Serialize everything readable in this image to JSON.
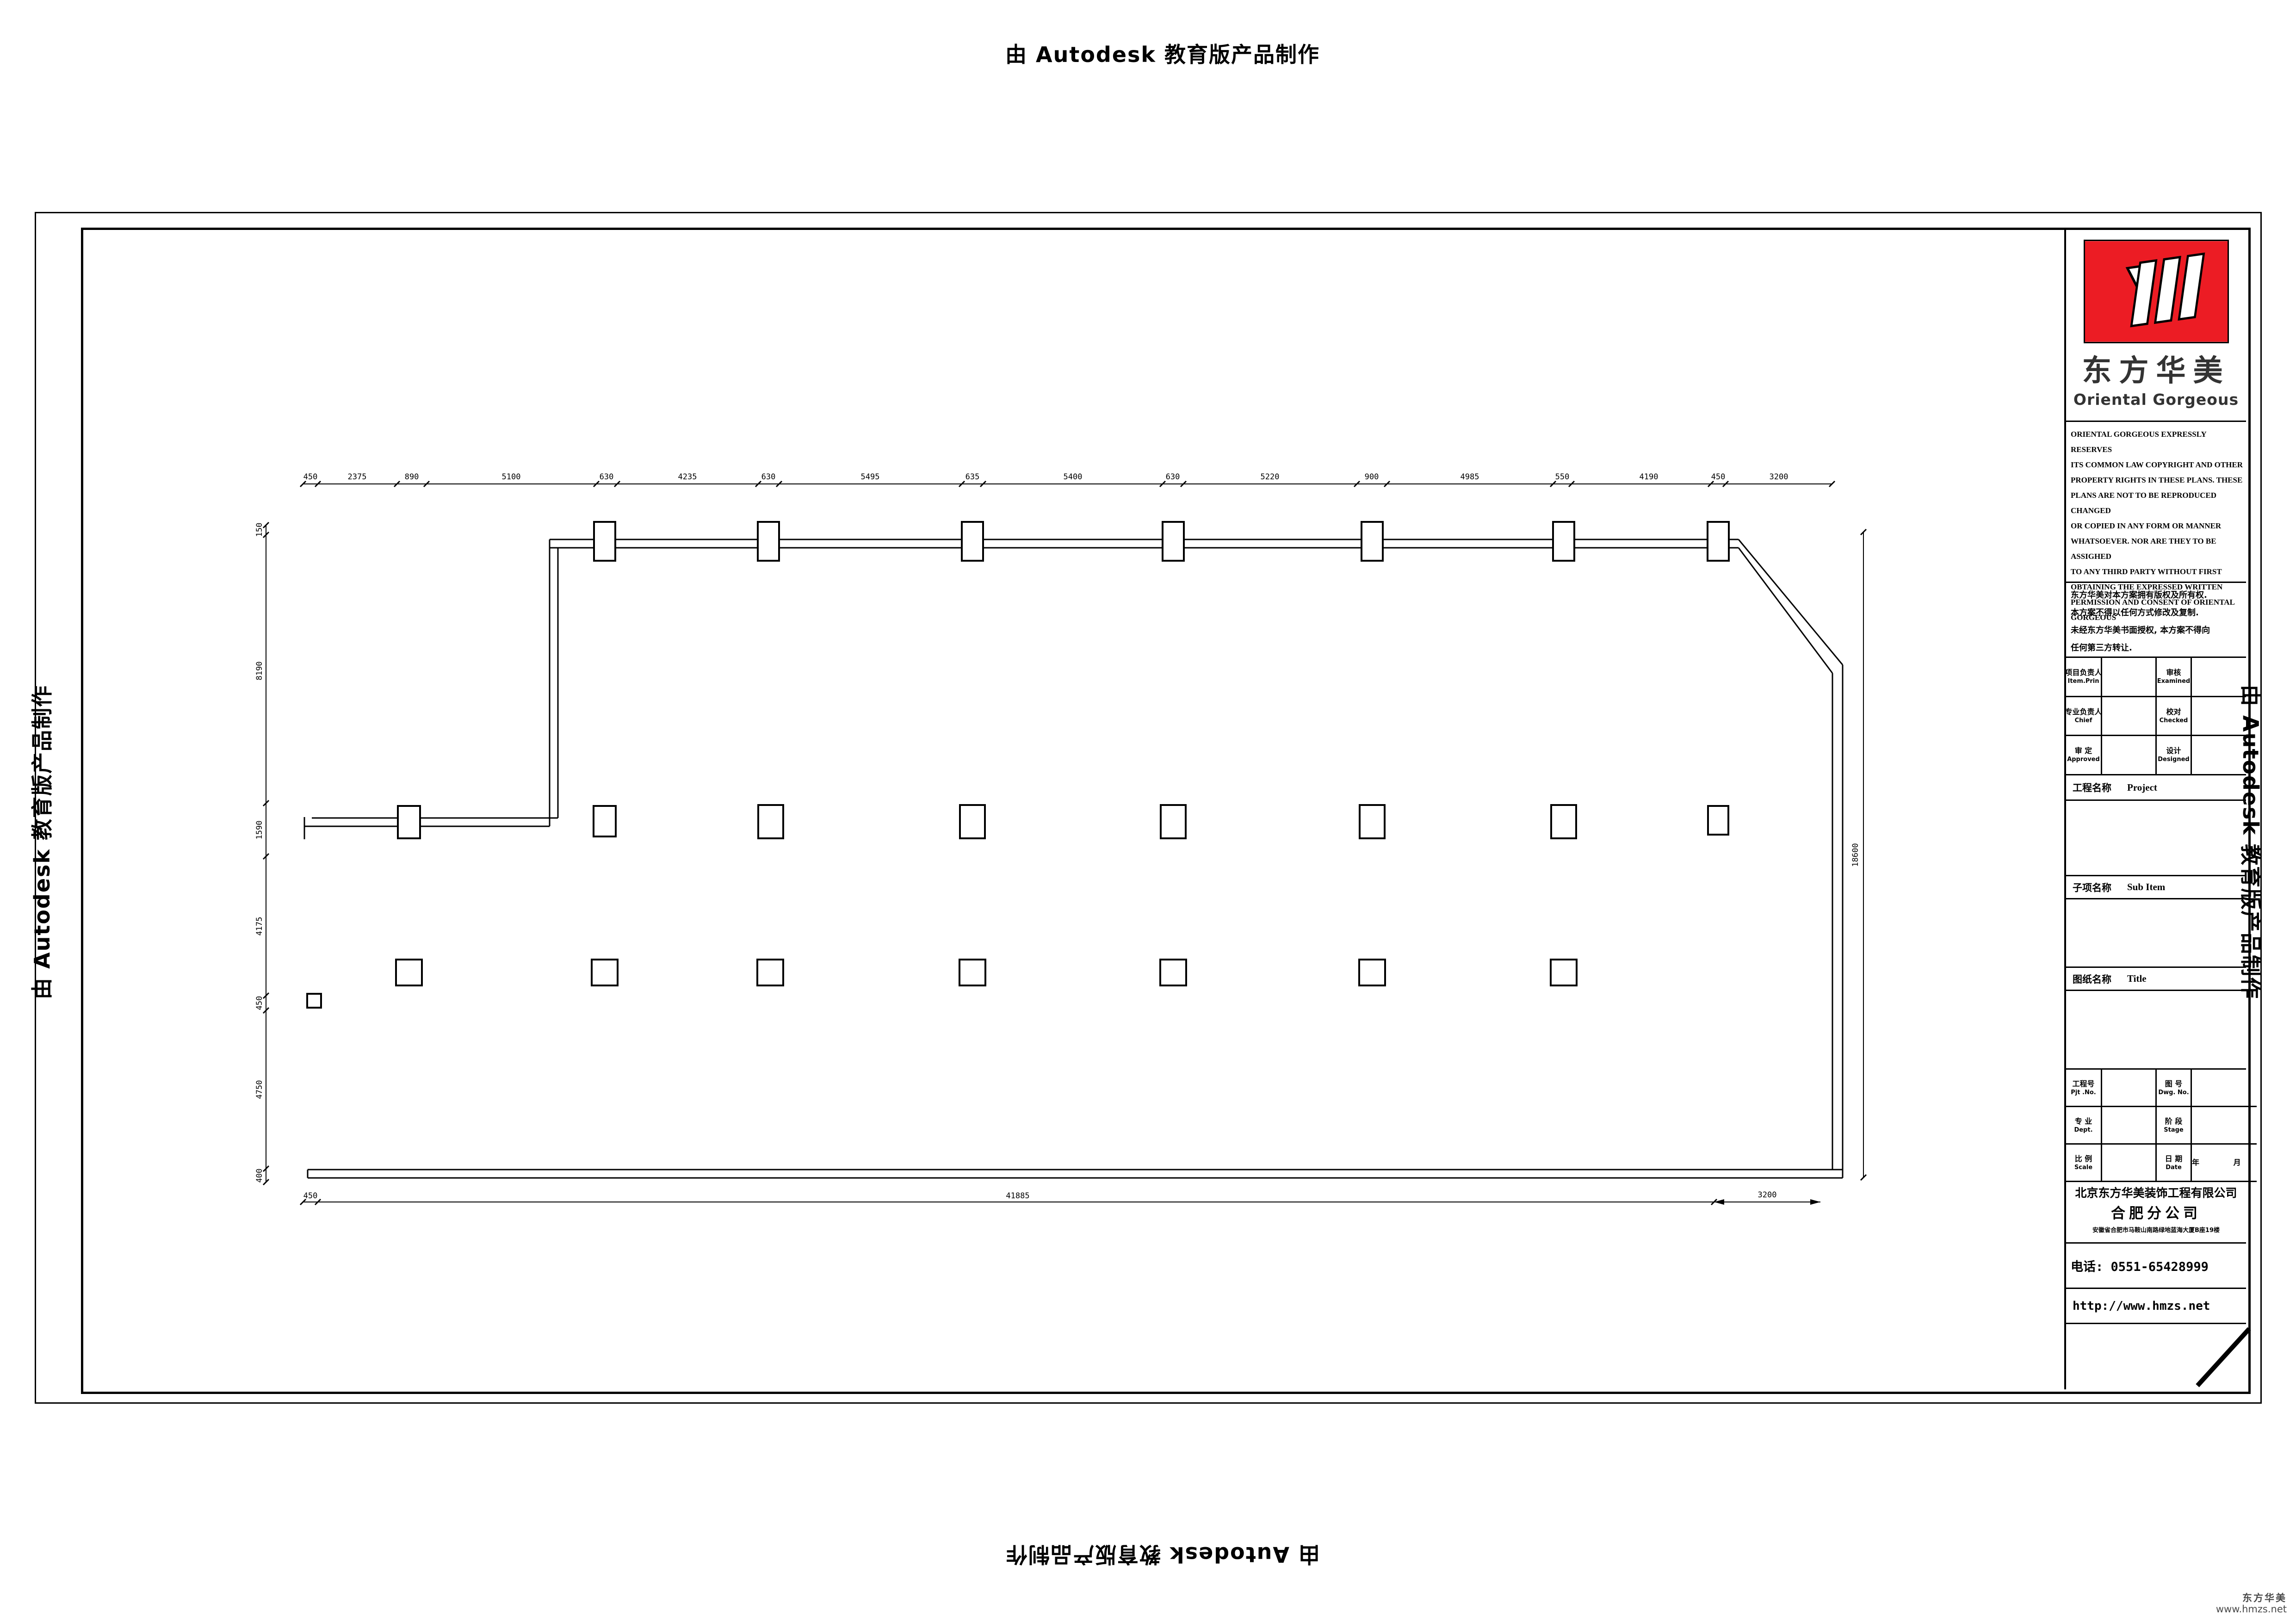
{
  "watermark": {
    "text": "由 Autodesk 教育版产品制作"
  },
  "title_block": {
    "logo": {
      "brand_cn": "东方华美",
      "brand_en": "Oriental  Gorgeous",
      "logo_color": "#ec1c24"
    },
    "copyright_en": "ORIENTAL GORGEOUS EXPRESSLY RESERVES\nITS COMMON LAW COPYRIGHT AND OTHER\nPROPERTY RIGHTS IN THESE PLANS. THESE\nPLANS ARE NOT TO BE REPRODUCED CHANGED\nOR COPIED IN ANY FORM OR MANNER\nWHATSOEVER. NOR ARE THEY TO BE ASSIGHED\nTO ANY THIRD PARTY WITHOUT FIRST\nOBTAINING THE EXPRESSED WRITTEN\nPERMISSION AND CONSENT OF ORIENTAL\nGORGEOUS",
    "copyright_cn": "东方华美对本方案拥有版权及所有权.\n本方案不得以任何方式修改及复制.\n未经东方华美书面授权, 本方案不得向\n任何第三方转让.",
    "personnel_rows": [
      {
        "c1": "项目负责人",
        "e1": "Item.Prin",
        "v1": "",
        "c2": "审核",
        "e2": "Examined",
        "v2": ""
      },
      {
        "c1": "专业负责人",
        "e1": "Chief",
        "v1": "",
        "c2": "校对",
        "e2": "Checked",
        "v2": ""
      },
      {
        "c1": "审 定",
        "e1": "Approved",
        "v1": "",
        "c2": "设计",
        "e2": "Designed",
        "v2": ""
      }
    ],
    "sections": {
      "project_cn": "工程名称",
      "project_en": "Project",
      "project_value": "",
      "subitem_cn": "子项名称",
      "subitem_en": "Sub Item",
      "subitem_value": "",
      "title_cn": "图纸名称",
      "title_en": "Title",
      "title_value": ""
    },
    "meta_rows": [
      {
        "c1": "工程号",
        "e1": "Pjt .No.",
        "v1": "",
        "c2": "图 号",
        "e2": "Dwg. No.",
        "v2": ""
      },
      {
        "c1": "专 业",
        "e1": "Dept.",
        "v1": "",
        "c2": "阶 段",
        "e2": "Stage",
        "v2": ""
      },
      {
        "c1": "比 例",
        "e1": "Scale",
        "v1": "",
        "c2": "日 期",
        "e2": "Date",
        "v2": "年  月"
      }
    ],
    "company": {
      "name": "北京东方华美装饰工程有限公司",
      "branch": "合肥分公司",
      "address": "安徽省合肥市马鞍山南路绿地蓝海大厦B座19楼",
      "phone": "电话: 0551-65428999",
      "website": "http://www.hmzs.net"
    }
  },
  "plan": {
    "top_dims": [
      "450",
      "2375",
      "890",
      "5100",
      "630",
      "4235",
      "630",
      "5495",
      "635",
      "5400",
      "630",
      "5220",
      "900",
      "4985",
      "550",
      "4190",
      "450",
      "3200"
    ],
    "left_dims": [
      "150",
      "8190",
      "1590",
      "4175",
      "450",
      "4750",
      "400"
    ],
    "bottom_dims": [
      "450",
      "41885"
    ],
    "bottom_right_dim": "3200",
    "right_dim": "18600"
  },
  "footer": {
    "brand": "东方华美",
    "site": "www.hmzs.net"
  }
}
